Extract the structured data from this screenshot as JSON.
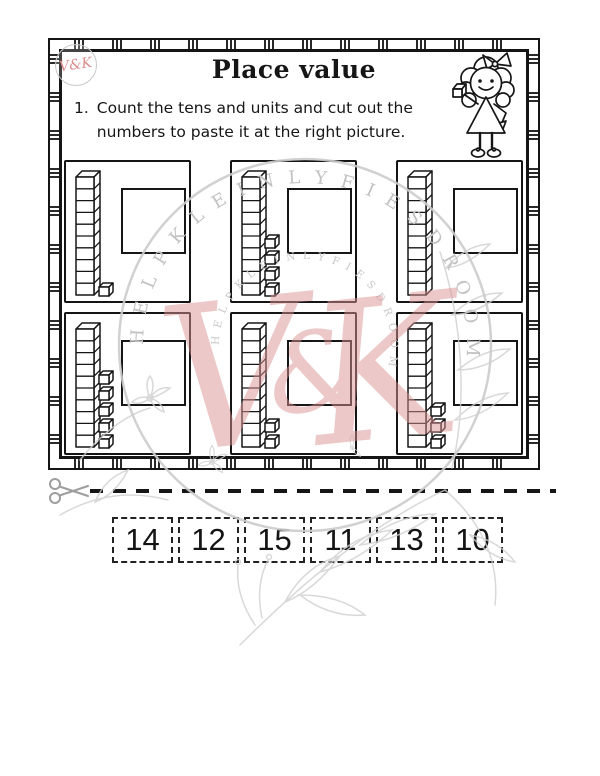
{
  "header": {
    "title": "Place value"
  },
  "instruction": {
    "number": "1.",
    "text": "Count the tens and units and cut out the numbers to paste it at the right picture."
  },
  "pictures": {
    "boxes": [
      {
        "tens": 1,
        "units": 1
      },
      {
        "tens": 1,
        "units": 4
      },
      {
        "tens": 1,
        "units": 0
      },
      {
        "tens": 1,
        "units": 5
      },
      {
        "tens": 1,
        "units": 2
      },
      {
        "tens": 1,
        "units": 3
      }
    ]
  },
  "cutout": {
    "numbers": [
      "14",
      "12",
      "15",
      "11",
      "13",
      "10"
    ]
  },
  "watermark": {
    "ring_text": "HELP KLEIN LYFIES DROOM",
    "monogram": "V&K",
    "pink_color": "#db9292",
    "gray_color": "#c6c6c6"
  },
  "logo": {
    "monogram": "V&K"
  },
  "icons": {
    "scissors": "✂"
  }
}
